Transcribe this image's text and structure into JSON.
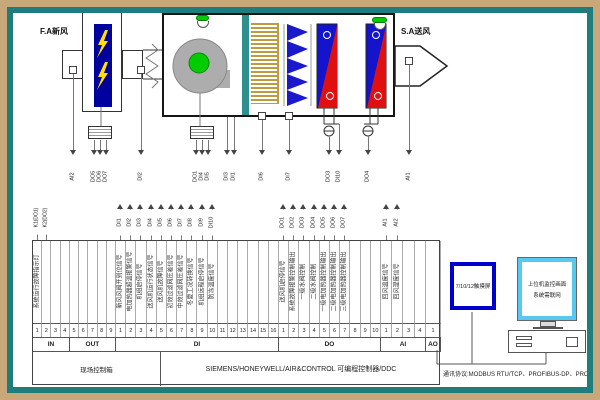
{
  "schematic": {
    "fa_label": "F.A新风",
    "sa_label": "S.A送风",
    "drop_labels": [
      "AI2",
      "DO5",
      "DO6",
      "DO7",
      "DI2",
      "DO1",
      "DI4",
      "DI5",
      "DI3",
      "DI1",
      "DI6",
      "DI7",
      "DO3",
      "DI10",
      "DO4",
      "AI1"
    ],
    "colors": {
      "heater": "#00009E",
      "bolt": "#FFE000",
      "fan_body": "#ADADAD",
      "fan_hub": "#00CC00",
      "filter_primary": "#C09A3E",
      "filter_bag": "#1A1ACC",
      "coil_blue": "#1414CC",
      "coil_red": "#E01010",
      "divider": "#2E8F8F",
      "indicator": "#00CC00"
    }
  },
  "io_table": {
    "groups": [
      {
        "section": "IN",
        "cols": [
          {
            "num": "1",
            "top": "K1(DO1)",
            "text": "系统运行故障指示灯"
          },
          {
            "num": "2",
            "top": "K2(DO2)"
          },
          {
            "num": "3"
          },
          {
            "num": "4"
          }
        ]
      },
      {
        "section": "OUT",
        "cols": [
          {
            "num": "5"
          },
          {
            "num": "6"
          },
          {
            "num": "7"
          },
          {
            "num": "8"
          },
          {
            "num": "9"
          }
        ]
      },
      {
        "section": "DI",
        "cols": [
          {
            "num": "1",
            "top": "DI1",
            "text": "新风风阀开到位信号"
          },
          {
            "num": "2",
            "top": "DI2",
            "text": "电加热器超温报警信号"
          },
          {
            "num": "3",
            "top": "DI3",
            "text": "机组启停信号"
          },
          {
            "num": "4",
            "top": "DI4",
            "text": "送风机运行状态信号"
          },
          {
            "num": "5",
            "top": "DI5",
            "text": "送风机故障信号"
          },
          {
            "num": "6",
            "top": "DI6",
            "text": "初效过滤网压差信号"
          },
          {
            "num": "7",
            "top": "DI7",
            "text": "中效过滤网压差信号"
          },
          {
            "num": "8",
            "top": "DI8",
            "text": "冬夏工况转换信号"
          },
          {
            "num": "9",
            "top": "DI9",
            "text": "机组远程启停信号"
          },
          {
            "num": "10",
            "top": "DI10",
            "text": "防冻温度信号"
          },
          {
            "num": "11"
          },
          {
            "num": "12"
          },
          {
            "num": "13"
          },
          {
            "num": "14"
          },
          {
            "num": "15"
          },
          {
            "num": "16"
          }
        ]
      },
      {
        "section": "DO",
        "cols": [
          {
            "num": "1",
            "top": "DO1",
            "text": "送风机启停信号"
          },
          {
            "num": "2",
            "top": "DO2",
            "text": "系统故障报警控制输出"
          },
          {
            "num": "3",
            "top": "DO3",
            "text": "一级水阀控制"
          },
          {
            "num": "4",
            "top": "DO4",
            "text": "二级水阀控制"
          },
          {
            "num": "5",
            "top": "DO5",
            "text": "一级电加热器控制输出"
          },
          {
            "num": "6",
            "top": "DO6",
            "text": "二级电加热器控制输出"
          },
          {
            "num": "7",
            "top": "DO7",
            "text": "三级电加热器控制输出"
          },
          {
            "num": "8"
          },
          {
            "num": "9"
          },
          {
            "num": "10"
          }
        ]
      },
      {
        "section": "AI",
        "cols": [
          {
            "num": "1",
            "top": "AI1",
            "text": "回风温度信号"
          },
          {
            "num": "2",
            "top": "AI2",
            "text": "回风湿度信号"
          },
          {
            "num": "3"
          },
          {
            "num": "4"
          }
        ]
      },
      {
        "section": "AO",
        "cols": [
          {
            "num": "1"
          }
        ]
      }
    ],
    "bottom_left": "现场控制箱",
    "bottom_main": "SIEMENS/HONEYWELL/AIR&CONTROL 可编程控制器/DDC"
  },
  "right_panel": {
    "touchscreen": "7/10/12触摸屏",
    "monitor_line1": "上位机监控画面",
    "monitor_line2": "系统需联网",
    "protocol": "通讯协议:MODBUS RTU/TCP、PROFIBUS-DP、PROFINET"
  }
}
